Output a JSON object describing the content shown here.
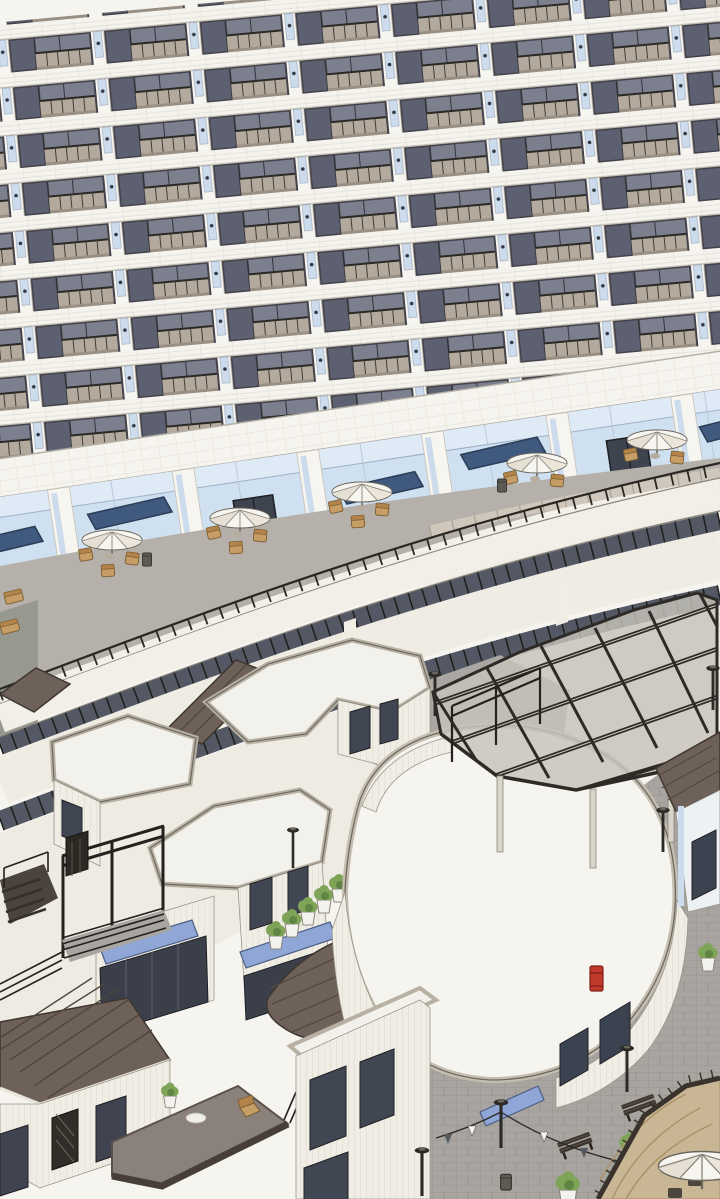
{
  "meta": {
    "description": "Axonometric 3D architectural rendering of a curved residential tower above a storefront terrace and low-rise retail village with plaza",
    "render_style": "sketchup-line-render"
  },
  "palette": {
    "wall_white": "#f3f1eb",
    "band_tile": "#f6f4ef",
    "window_glass": "#7b7f8e",
    "window_dark": "#414653",
    "balcony_panel": "#b3aa9d",
    "pier_blue": "#cddcec",
    "storefront_glass": "#cfe0f0",
    "awning_dark": "#40597e",
    "awning_light": "#8fa6d6",
    "terrace_floor": "#b5b0a9",
    "curve_wall": "#efece4",
    "clerestory": "#545864",
    "canopy_glass": "#c7c3bb",
    "frame_dark": "#2e2b27",
    "roof_brown": "#6e6159",
    "plaza_paver": "#a8a4a0",
    "deck_tan": "#c9b694",
    "plant_green": "#7fa457",
    "planter_white": "#f4f2ee",
    "postbox_red": "#c0392b",
    "bench_wood": "#3d362f",
    "furniture_tan": "#c79d66",
    "umbrella_white": "#f7f5ef"
  },
  "scene": {
    "tower": {
      "visible_floor_rows": 9,
      "bay_module": "pier with blue panel + dark glass window + beige balcony rail",
      "facade_tilt_deg": -5.3
    },
    "storefront_level": {
      "awnings": 5,
      "double_doors": 2,
      "terrace_umbrellas": 5,
      "trash_bins": 3,
      "railing": "curved promenade railing with stone cap on right"
    },
    "curved_podium": {
      "clerestory_strips": 2,
      "glass_canopy_bays": 10
    },
    "village": {
      "flat_white_roofs": 4,
      "brown_roofs": 5,
      "pergola": 1,
      "planters": 10,
      "benches": 2,
      "lamp_posts": 7,
      "postbox": 1,
      "string_light_pennants": 6,
      "deck_umbrella": 1,
      "stairs": 1
    }
  }
}
